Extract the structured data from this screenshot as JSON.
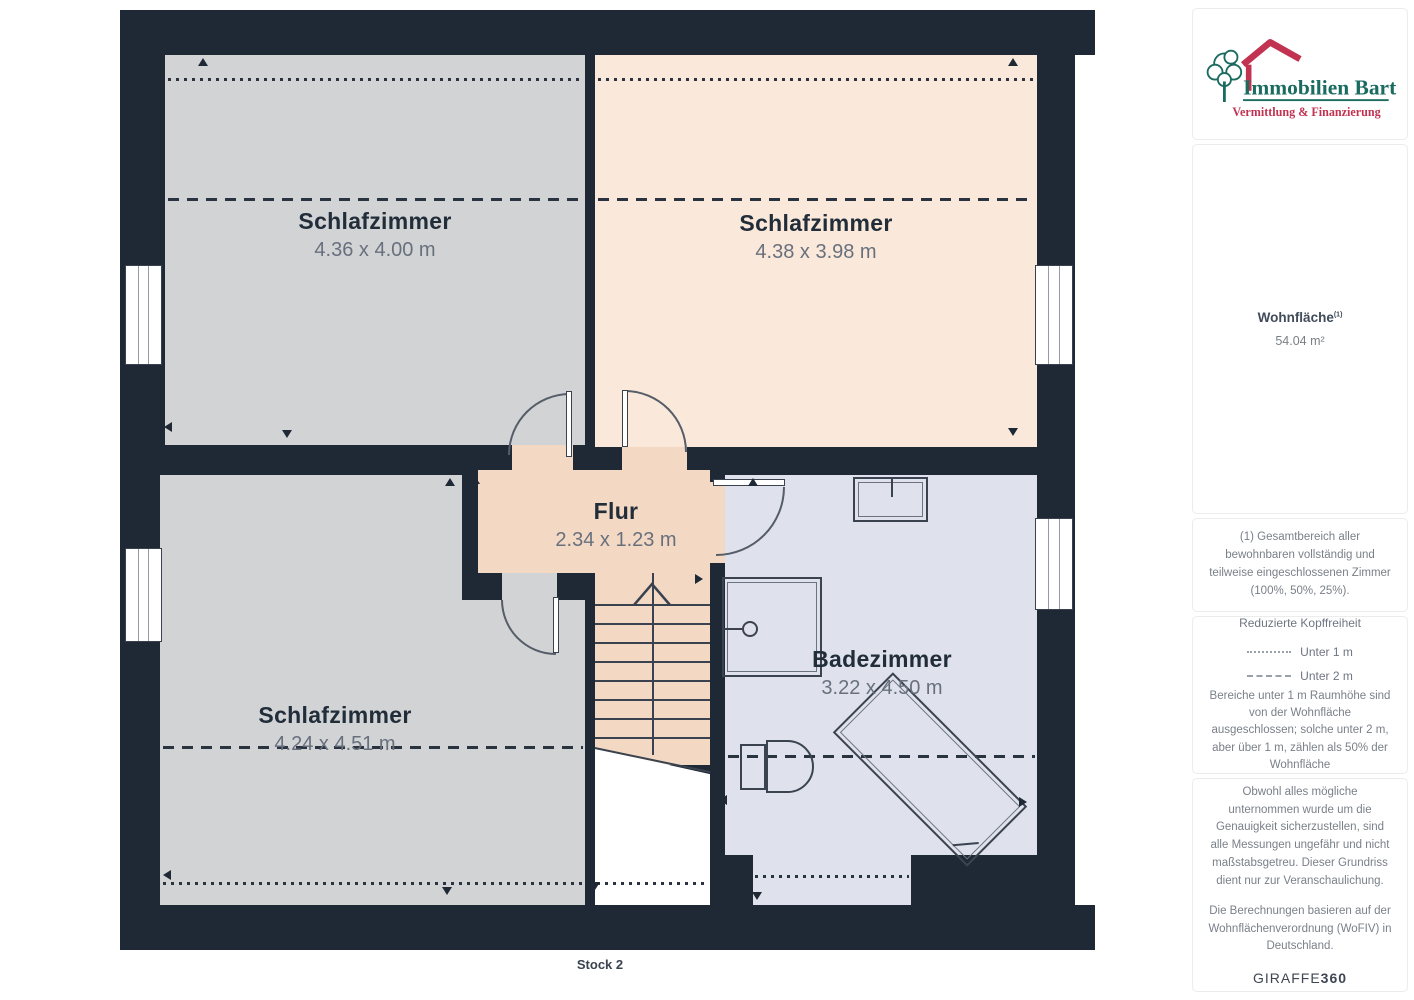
{
  "floorplan": {
    "level_label": "Stock 2",
    "rooms": [
      {
        "name": "Schlafzimmer",
        "dimensions": "4.36 x 4.00 m"
      },
      {
        "name": "Schlafzimmer",
        "dimensions": "4.38 x 3.98 m"
      },
      {
        "name": "Schlafzimmer",
        "dimensions": "4.24 x 4.51 m"
      },
      {
        "name": "Flur",
        "dimensions": "2.34 x 1.23 m"
      },
      {
        "name": "Badezimmer",
        "dimensions": "3.22 x 4.50 m"
      }
    ],
    "colors": {
      "wall": "#1f2935",
      "room_gray": "#d2d3d5",
      "room_cream": "#fae9da",
      "room_salmon": "#f3d8c3",
      "room_blue": "#dfe2ed"
    }
  },
  "sidebar": {
    "logo": {
      "title": "Immobilien Bart",
      "subtitle": "Vermittlung & Finanzierung",
      "teal": "#1a6b60",
      "crimson": "#c23352"
    },
    "area": {
      "label": "Wohnfläche",
      "footnote_marker": "(1)",
      "value": "54.04 m²"
    },
    "footnote": "(1) Gesamtbereich aller bewohnbaren vollständig und teilweise eingeschlossenen Zimmer (100%, 50%, 25%).",
    "legend": {
      "title": "Reduzierte Kopffreiheit",
      "items": [
        {
          "label": "Unter 1 m"
        },
        {
          "label": "Unter 2 m"
        }
      ],
      "description": "Bereiche unter 1 m Raumhöhe sind von der Wohnfläche ausgeschlossen; solche unter 2 m, aber über 1 m, zählen als 50% der Wohnfläche"
    },
    "disclaimer": {
      "paragraph1": "Obwohl alles mögliche unternommen wurde um die Genauigkeit sicherzustellen, sind alle Messungen ungefähr und nicht maßstabsgetreu. Dieser Grundriss dient nur zur Veranschaulichung.",
      "paragraph2": "Die Berechnungen basieren auf der Wohnflächenverordnung (WoFIV) in Deutschland.",
      "brand": "GIRAFFE",
      "brand_suffix": "360"
    }
  }
}
